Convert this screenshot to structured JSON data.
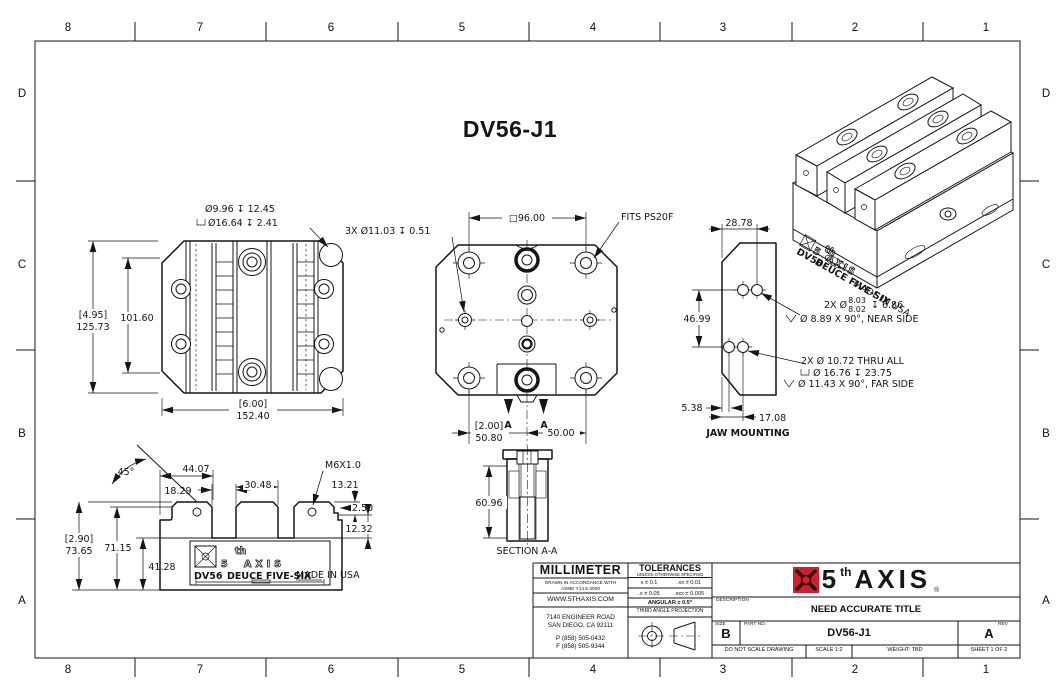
{
  "sheet": {
    "title": "DV56-J1",
    "zone_cols": [
      "8",
      "7",
      "6",
      "5",
      "4",
      "3",
      "2",
      "1"
    ],
    "zone_rows": [
      "D",
      "C",
      "B",
      "A"
    ],
    "accent_red": "#cf2030",
    "line_color": "#151515"
  },
  "front_view": {
    "callout_line1": "Ø9.96 ↧ 12.45",
    "callout_line2": "Ø16.64 ↧ 2.41",
    "height_ref": "[4.95]",
    "height": "125.73",
    "hole_spacing": "101.60",
    "width_ref": "[6.00]",
    "width": "152.40"
  },
  "top_view": {
    "bolt_pattern": "□96.00",
    "cbore_callout": "3X Ø11.03 ↧ 0.51",
    "fits_label": "FITS PS20F",
    "offset_ref": "[2.00]",
    "offset": "50.80",
    "spacing": "50.00",
    "section_letter": "A"
  },
  "jaw_view": {
    "label": "JAW MOUNTING",
    "width": "28.78",
    "vertical_spacing": "46.99",
    "edge_offset": "5.38",
    "hole_offset": "17.08",
    "note1_prefix": "2X Ø",
    "note1_upper": "8.03",
    "note1_lower": "8.02",
    "note1_suffix": "↧ 6.86",
    "note1_csk": "Ø 8.89 X 90°, NEAR SIDE",
    "note2_thru": "2X Ø 10.72 THRU ALL",
    "note2_cbore": "Ø 16.76 ↧ 23.75",
    "note2_csk": "Ø 11.43 X 90°, FAR SIDE"
  },
  "side_view": {
    "angle": "45°",
    "jaw_to_slot": "44.07",
    "slot_width": "18.29",
    "jaw_width": "30.48",
    "thread": "M6X1.0",
    "step_height": "13.21",
    "step_depth": "2.50",
    "ledge_height": "12.32",
    "height_ref": "[2.90]",
    "height": "73.65",
    "body_height": "71.15",
    "base_height": "41.28",
    "plaque": {
      "brand_num": "5",
      "brand_sup": "th",
      "brand_name": "AXIS",
      "model": "DV56",
      "series": "DEUCE FIVE-SIX",
      "origin": "MADE IN USA"
    }
  },
  "section_view": {
    "label": "SECTION A-A",
    "depth": "60.96"
  },
  "iso_view": {
    "brand_num": "5",
    "brand_sup": "th",
    "brand_name": "AXIS",
    "model": "DV56",
    "series": "DEUCE FIVE-SIX",
    "origin": "MADE IN USA"
  },
  "title_block": {
    "units": "MILLIMETER",
    "accordance_line1": "DRAWN IN ACCORDANCE WITH",
    "accordance_line2": "ASME Y14.5-2009",
    "website": "WWW.5THAXIS.COM",
    "address_line1": "7140 ENGINEER ROAD",
    "address_line2": "SAN DIEGO, CA 92111",
    "phone": "P (858) 505-0432",
    "fax": "F (858) 505-9344",
    "tolerances_title": "TOLERANCES",
    "tolerances_sub": "UNLESS OTHERWISE SPECIFIED",
    "tol_x": "x ± 0.1",
    "tol_xx": ".xx ± 0.01",
    "tol_x2": ".x ± 0.05",
    "tol_xxx": ".xxx ± 0.005",
    "tol_angular": "ANGULAR ± 0.5°",
    "projection": "THIRD ANGLE PROJECTION",
    "brand": {
      "num": "5",
      "sup": "th",
      "name": "AXIS",
      "reg": "®"
    },
    "description_label": "DESCRIPTION",
    "description": "NEED ACCURATE TITLE",
    "size_label": "SIZE",
    "size": "B",
    "part_label": "PART NO.",
    "part_no": "DV56-J1",
    "rev_label": "REV",
    "rev": "A",
    "no_scale": "DO NOT SCALE DRAWING",
    "scale": "SCALE 1:2",
    "weight": "WEIGHT: TBD",
    "sheet": "SHEET 1 OF 2"
  }
}
